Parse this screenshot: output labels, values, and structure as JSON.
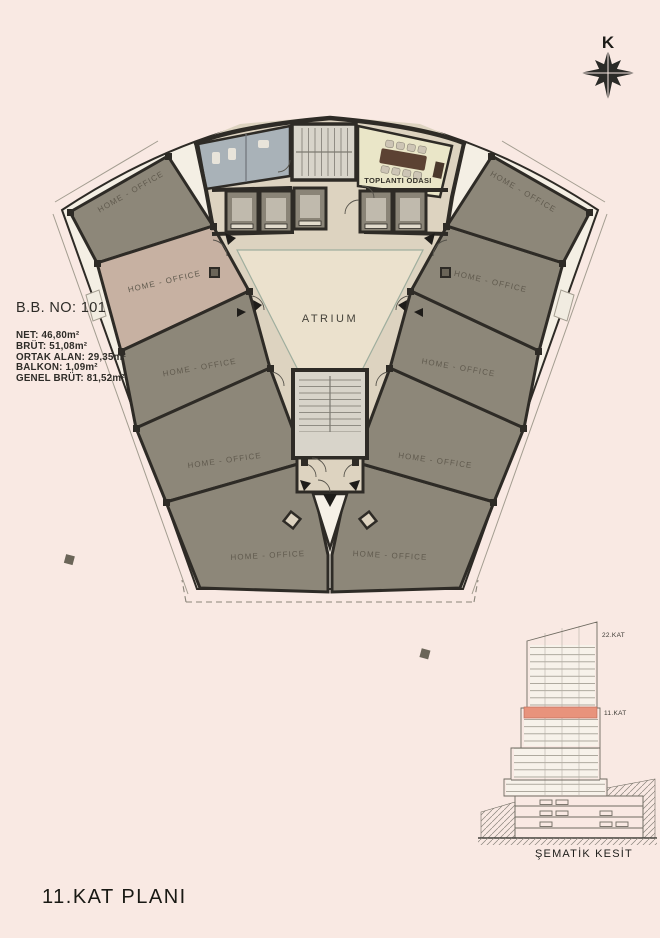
{
  "title": "11.KAT PLANI",
  "north": {
    "label": "K"
  },
  "info_block": {
    "unit_no": "B.B. NO: 101",
    "areas": [
      "NET: 46,80m²",
      "BRÜT: 51,08m²",
      "ORTAK ALAN: 29,35m²",
      "BALKON: 1,09m²",
      "GENEL BRÜT: 81,52m²"
    ]
  },
  "plan": {
    "atrium_label": "ATRIUM",
    "meeting_room_label": "TOPLANTI ODASI",
    "units": [
      {
        "id": "top-left",
        "label": "HOME - OFFICE",
        "highlighted": false
      },
      {
        "id": "left-upper",
        "label": "HOME - OFFICE",
        "highlighted": true
      },
      {
        "id": "left-middle",
        "label": "HOME - OFFICE",
        "highlighted": false
      },
      {
        "id": "left-lower",
        "label": "HOME - OFFICE",
        "highlighted": false
      },
      {
        "id": "bottom-left",
        "label": "HOME - OFFICE",
        "highlighted": false
      },
      {
        "id": "bottom-right",
        "label": "HOME - OFFICE",
        "highlighted": false
      },
      {
        "id": "right-lower",
        "label": "HOME - OFFICE",
        "highlighted": false
      },
      {
        "id": "right-middle",
        "label": "HOME - OFFICE",
        "highlighted": false
      },
      {
        "id": "right-upper",
        "label": "HOME - OFFICE",
        "highlighted": false
      },
      {
        "id": "top-right",
        "label": "HOME - OFFICE",
        "highlighted": false
      }
    ]
  },
  "section": {
    "caption": "ŞEMATİK KESİT",
    "upper_floor_label": "22.KAT",
    "highlight_floor_label": "11.KAT"
  },
  "colors": {
    "bg": "#f9e9e3",
    "wall": "#2e2b26",
    "unit_gray": "#8d8779",
    "unit_hl": "#c7b1a2",
    "corridor": "#ddd3c0",
    "atrium": "#ebe1cd",
    "wc": "#a9b2b8",
    "meeting": "#eae6c8",
    "table": "#5c4233",
    "stair": "#d8d4ca",
    "footprint": "#f4efe4",
    "section_highlight": "#e8937c"
  }
}
